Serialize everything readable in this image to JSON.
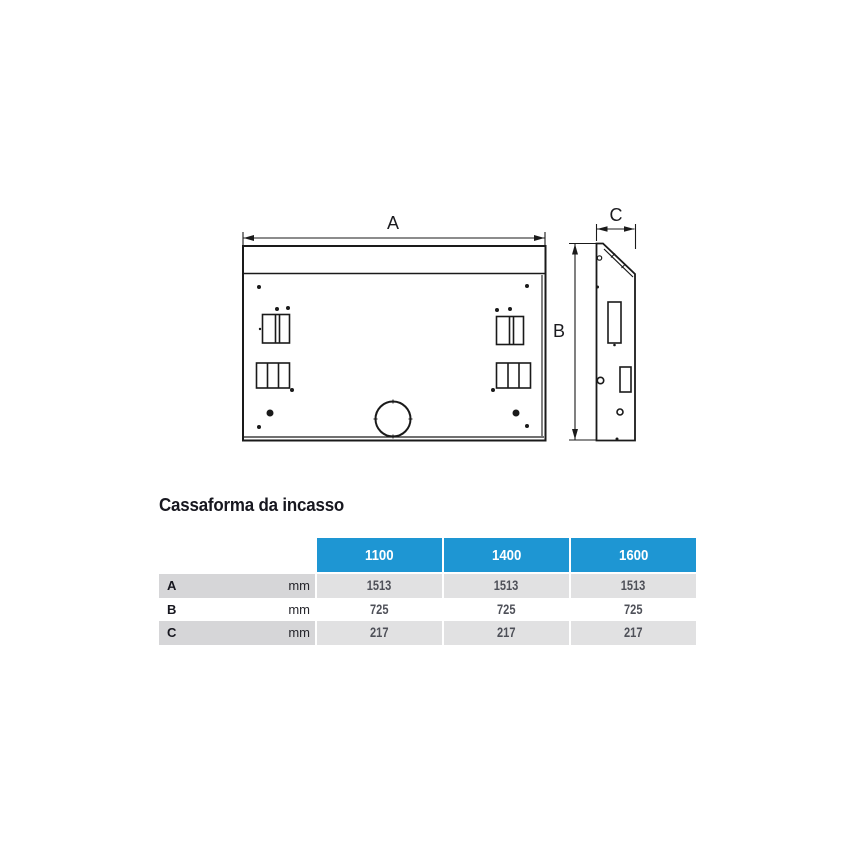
{
  "section": {
    "title": "Cassaforma da incasso"
  },
  "drawing": {
    "dim_a_label": "A",
    "dim_b_label": "B",
    "dim_c_label": "C",
    "line_color": "#1a1a1a"
  },
  "table": {
    "header_color": "#1e96d3",
    "stripe_label_color": "#d6d6d8",
    "stripe_value_color": "#e1e1e2",
    "unit": "mm",
    "columns": [
      "1100",
      "1400",
      "1600"
    ],
    "rows": [
      {
        "label": "A",
        "unit": "mm",
        "values": [
          "1513",
          "1513",
          "1513"
        ]
      },
      {
        "label": "B",
        "unit": "mm",
        "values": [
          "725",
          "725",
          "725"
        ]
      },
      {
        "label": "C",
        "unit": "mm",
        "values": [
          "217",
          "217",
          "217"
        ]
      }
    ]
  }
}
